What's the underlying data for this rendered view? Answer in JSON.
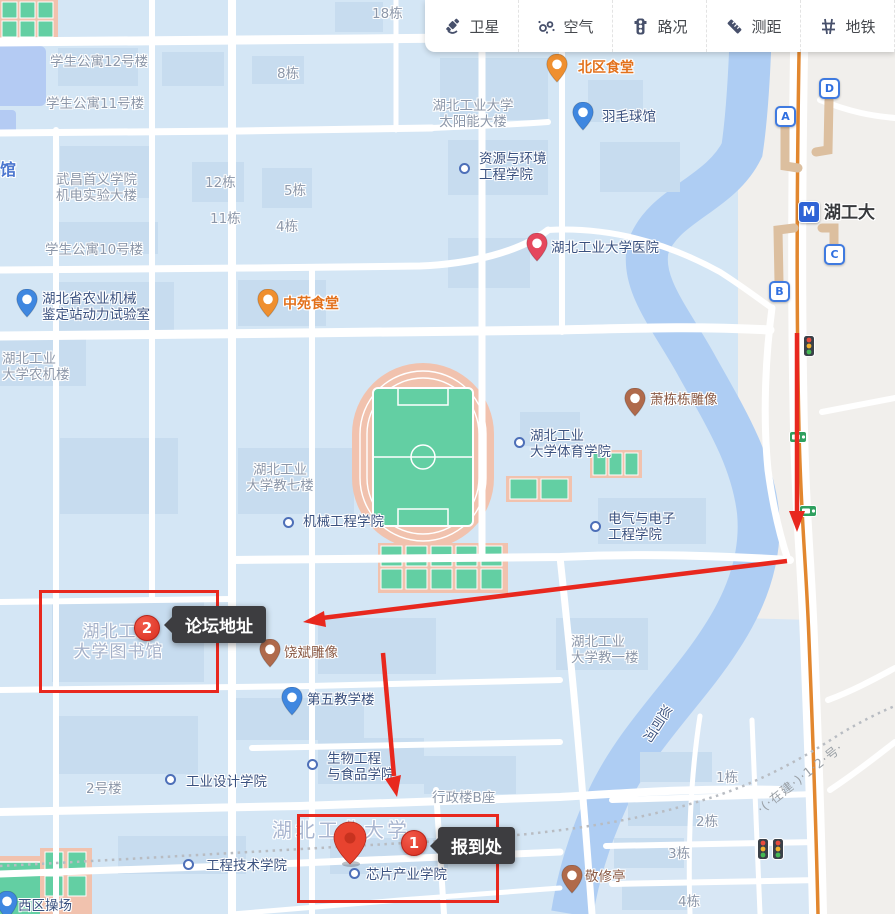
{
  "toolbar": {
    "items": [
      {
        "id": "satellite",
        "label": "卫星",
        "icon": "satellite-icon"
      },
      {
        "id": "air",
        "label": "空气",
        "icon": "air-quality-icon"
      },
      {
        "id": "traffic",
        "label": "路况",
        "icon": "traffic-light-icon"
      },
      {
        "id": "measure",
        "label": "测距",
        "icon": "ruler-icon"
      },
      {
        "id": "metro",
        "label": "地铁",
        "icon": "metro-lines-icon"
      }
    ]
  },
  "annotations": {
    "forum": {
      "number": "2",
      "label": "论坛地址"
    },
    "checkin": {
      "number": "1",
      "label": "报到处"
    }
  },
  "metro": {
    "station_name": "湖工大",
    "exits": [
      {
        "label": "A",
        "x": 785,
        "y": 116
      },
      {
        "label": "B",
        "x": 779,
        "y": 291
      },
      {
        "label": "C",
        "x": 834,
        "y": 254
      },
      {
        "label": "D",
        "x": 829,
        "y": 88
      }
    ]
  },
  "river_label": "巡司河",
  "construction_label": "·(·在建·)·1·2·号·",
  "map": {
    "labels": [
      {
        "t": "18栋",
        "x": 372,
        "y": 6,
        "c": "gray"
      },
      {
        "t": "学生公寓12号楼",
        "x": 50,
        "y": 54,
        "c": "gray"
      },
      {
        "t": "8栋",
        "x": 277,
        "y": 66,
        "c": "gray"
      },
      {
        "t": "北区食堂",
        "x": 578,
        "y": 60,
        "c": "orange"
      },
      {
        "t": "学生公寓11号楼",
        "x": 46,
        "y": 96,
        "c": "gray"
      },
      {
        "t": "湖北工业大学\n太阳能大楼",
        "x": 420,
        "y": 98,
        "c": "gray",
        "w": 106
      },
      {
        "t": "羽毛球馆",
        "x": 602,
        "y": 109,
        "c": "poi"
      },
      {
        "t": "资源与环境\n工程学院",
        "x": 479,
        "y": 151,
        "c": "poi"
      },
      {
        "t": "武昌首义学院\n机电实验大楼",
        "x": 56,
        "y": 172,
        "c": "gray"
      },
      {
        "t": "12栋",
        "x": 205,
        "y": 175,
        "c": "gray"
      },
      {
        "t": "5栋",
        "x": 284,
        "y": 183,
        "c": "gray"
      },
      {
        "t": "11栋",
        "x": 210,
        "y": 211,
        "c": "gray"
      },
      {
        "t": "4栋",
        "x": 276,
        "y": 219,
        "c": "gray"
      },
      {
        "t": "学生公寓10号楼",
        "x": 45,
        "y": 242,
        "c": "gray"
      },
      {
        "t": "湖北工业大学医院",
        "x": 551,
        "y": 240,
        "c": "poi"
      },
      {
        "t": "中苑食堂",
        "x": 283,
        "y": 296,
        "c": "orange"
      },
      {
        "t": "湖北省农业机械\n鉴定站动力试验室",
        "x": 42,
        "y": 291,
        "c": "poi"
      },
      {
        "t": "湖北工业\n大学农机楼",
        "x": 2,
        "y": 351,
        "c": "gray"
      },
      {
        "t": "萧栋栋雕像",
        "x": 650,
        "y": 392,
        "c": "statue"
      },
      {
        "t": "湖北工业\n大学体育学院",
        "x": 530,
        "y": 428,
        "c": "poi"
      },
      {
        "t": "湖北工业\n大学教七楼",
        "x": 234,
        "y": 462,
        "c": "gray",
        "w": 92
      },
      {
        "t": "机械工程学院",
        "x": 303,
        "y": 514,
        "c": "poi"
      },
      {
        "t": "电气与电子\n工程学院",
        "x": 608,
        "y": 511,
        "c": "poi"
      },
      {
        "t": "湖北工业\n大学图书馆",
        "x": 62,
        "y": 622,
        "c": "lightgray",
        "w": 113
      },
      {
        "t": "饶斌雕像",
        "x": 284,
        "y": 645,
        "c": "statue"
      },
      {
        "t": "湖北工业\n大学教一楼",
        "x": 571,
        "y": 634,
        "c": "gray"
      },
      {
        "t": "第五教学楼",
        "x": 307,
        "y": 692,
        "c": "poi"
      },
      {
        "t": "生物工程\n与食品学院",
        "x": 327,
        "y": 751,
        "c": "poi"
      },
      {
        "t": "工业设计学院",
        "x": 186,
        "y": 774,
        "c": "poi"
      },
      {
        "t": "2号楼",
        "x": 86,
        "y": 781,
        "c": "gray"
      },
      {
        "t": "行政楼B座",
        "x": 432,
        "y": 790,
        "c": "gray"
      },
      {
        "t": "湖北工业大学",
        "x": 272,
        "y": 818,
        "c": "campus"
      },
      {
        "t": "工程技术学院",
        "x": 206,
        "y": 858,
        "c": "poi"
      },
      {
        "t": "芯片产业学院",
        "x": 366,
        "y": 867,
        "c": "poi"
      },
      {
        "t": "敬修亭",
        "x": 585,
        "y": 869,
        "c": "statue"
      },
      {
        "t": "1栋",
        "x": 716,
        "y": 770,
        "c": "gray"
      },
      {
        "t": "2栋",
        "x": 696,
        "y": 814,
        "c": "gray"
      },
      {
        "t": "3栋",
        "x": 668,
        "y": 846,
        "c": "gray"
      },
      {
        "t": "4栋",
        "x": 678,
        "y": 894,
        "c": "gray"
      },
      {
        "t": "西区操场",
        "x": 18,
        "y": 898,
        "c": "poi"
      },
      {
        "t": "馆",
        "x": 0,
        "y": 160,
        "c": "bluewater"
      },
      {
        "t": "湖工大",
        "x": 824,
        "y": 203,
        "c": "metro-name"
      }
    ],
    "dots": [
      {
        "x": 463,
        "y": 167
      },
      {
        "x": 518,
        "y": 441
      },
      {
        "x": 287,
        "y": 521
      },
      {
        "x": 594,
        "y": 525
      },
      {
        "x": 311,
        "y": 763
      },
      {
        "x": 169,
        "y": 778
      },
      {
        "x": 187,
        "y": 863
      },
      {
        "x": 353,
        "y": 872
      }
    ],
    "pins": [
      {
        "k": "canteen",
        "x": 557,
        "y": 82,
        "c": "#ef8f2f"
      },
      {
        "k": "canteen",
        "x": 268,
        "y": 317,
        "c": "#ef8f2f"
      },
      {
        "k": "badminton",
        "x": 583,
        "y": 130,
        "c": "#3f87e0"
      },
      {
        "k": "hospital",
        "x": 537,
        "y": 261,
        "c": "#e5485d"
      },
      {
        "k": "lab",
        "x": 27,
        "y": 317,
        "c": "#3f87e0"
      },
      {
        "k": "statue",
        "x": 635,
        "y": 416,
        "c": "#b06a4b"
      },
      {
        "k": "statue",
        "x": 270,
        "y": 667,
        "c": "#b06a4b"
      },
      {
        "k": "school",
        "x": 292,
        "y": 715,
        "c": "#3f87e0"
      },
      {
        "k": "pavilion",
        "x": 572,
        "y": 893,
        "c": "#b06a4b"
      },
      {
        "k": "playground",
        "x": 7,
        "y": 919,
        "c": "#3f87e0"
      }
    ],
    "traffic_lights": [
      {
        "x": 803,
        "y": 335
      },
      {
        "x": 757,
        "y": 838
      },
      {
        "x": 772,
        "y": 838
      }
    ],
    "road_cameras": [
      {
        "x": 789,
        "y": 429
      },
      {
        "x": 799,
        "y": 503
      }
    ]
  },
  "colors": {
    "annotation_red": "#e8281e",
    "tooltip_bg": "#3d3d40",
    "poi_text": "#3a517f",
    "orange_poi": "#e2711c",
    "campus_bg": "#d4e6f5",
    "river": "#aecdf3",
    "outside_bg": "#f1efec",
    "metro_line_orange": "#e2872f",
    "metro_blue": "#2f63d6"
  }
}
